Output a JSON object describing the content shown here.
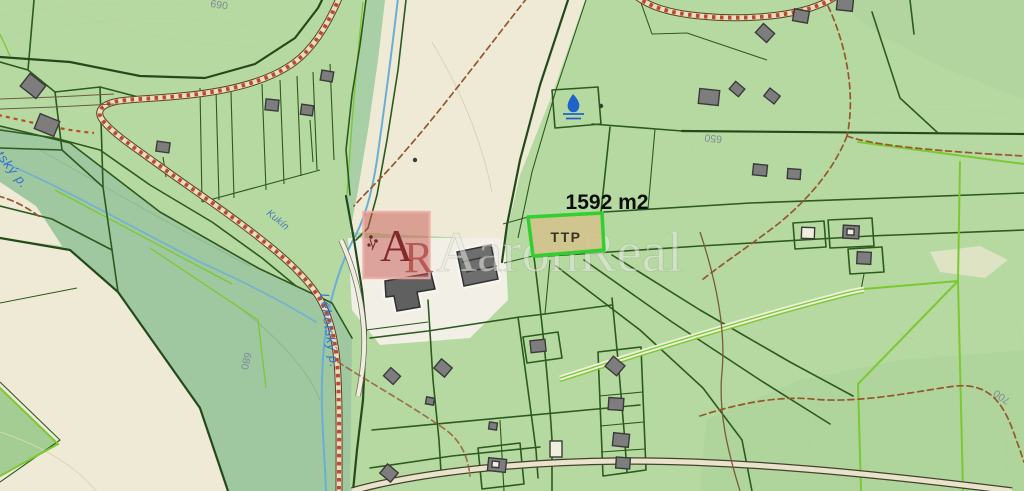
{
  "map": {
    "area_label": "1592 m2",
    "parcel_label": "TTP",
    "stream_labels": [
      "Lehotský p.",
      "Lehotský p.",
      "Kukín"
    ],
    "contour_labels": [
      "650",
      "680",
      "700",
      "690"
    ]
  },
  "watermark": {
    "logo_letter_a": "A",
    "logo_letter_r": "R",
    "name": "AaronReal"
  },
  "colors": {
    "base": "#b6d9a1",
    "forest": "#9fc8a1",
    "beige": "#efead6",
    "white_zone": "#f2f0e6",
    "boundary": "#2d5a1e",
    "boundary_dark": "#24491a",
    "lime": "#7cc832",
    "road_casing": "#5d4226",
    "road_fill": "#e8ddc2",
    "road_ties": "#bc4a2c",
    "trail": "#95572f",
    "stream": "#6aaed6",
    "stream_label": "#3572c8",
    "building_fill": "#7d7d7d",
    "building_stroke": "#3a3a3a",
    "parcel_fill": "#d2c38c",
    "parcel_stroke": "#2fd02f",
    "area_label_color": "#0d0d0d",
    "ttp_color": "#34342a",
    "watermark_red": "rgba(197,92,86,0.52)",
    "watermark_border": "rgba(238,172,166,0.85)",
    "watermark_letter_a": "rgba(120,28,30,0.9)",
    "watermark_letter_r": "rgba(172,72,66,0.8)",
    "watermark_text": "rgba(233,234,227,0.55)",
    "contour_label": "#7d8c96",
    "spring": "#1f63c8"
  }
}
